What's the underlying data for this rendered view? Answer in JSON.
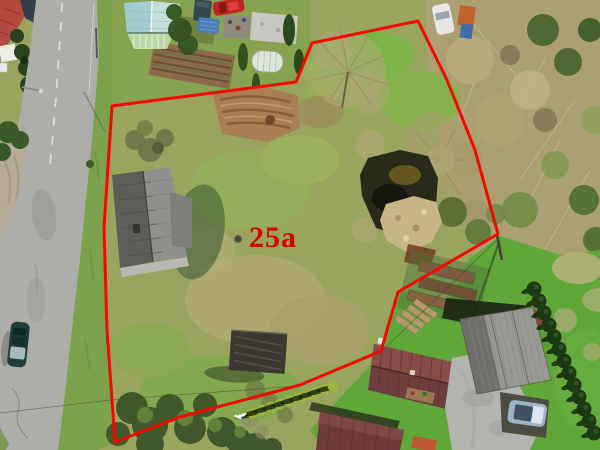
{
  "image": {
    "width": 600,
    "height": 450,
    "kind": "aerial-drone-photo-of-land-plot"
  },
  "annotation": {
    "plot_label": "25a",
    "label_color": "#d90000",
    "label_x": 273,
    "label_y": 247,
    "label_font_size": 30,
    "boundary_color": "#f60800",
    "boundary_width": 3,
    "boundary_points": "112,106 296,82 312,43 418,21 447,80 475,150 498,234 398,292 381,351 300,385 180,417 115,442 107,330 104,228"
  }
}
